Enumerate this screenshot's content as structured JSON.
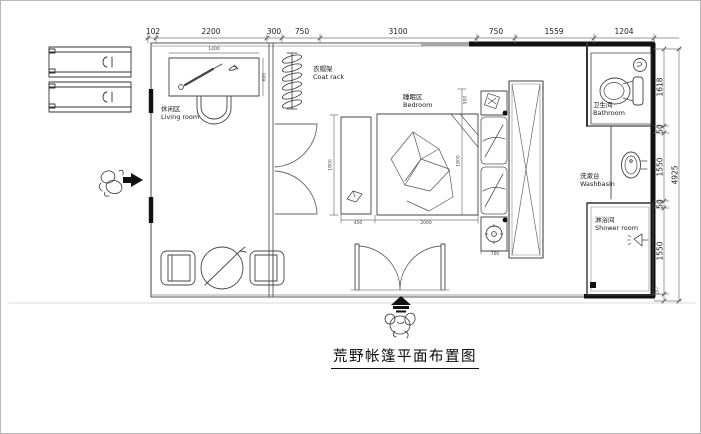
{
  "title": "荒野帐篷平面布置图",
  "rooms": {
    "living": {
      "zh": "休闲区",
      "en": "Living room"
    },
    "coat_rack": {
      "zh": "衣帽架",
      "en": "Coat rack"
    },
    "bedroom": {
      "zh": "睡眠区",
      "en": "Bedroom"
    },
    "bathroom": {
      "zh": "卫生间",
      "en": "Bathroom"
    },
    "washbasin": {
      "zh": "洗漱台",
      "en": "Washbasin"
    },
    "shower": {
      "zh": "淋浴间",
      "en": "Shower room"
    }
  },
  "dims": {
    "top": [
      "102",
      "2200",
      "300",
      "750",
      "3100",
      "750",
      "1559",
      "1204"
    ],
    "right": [
      "1618",
      "50",
      "1550",
      "50",
      "1550",
      "107"
    ],
    "right_overall": "4925",
    "small": {
      "desk_width": "1400",
      "desk_depth": "600",
      "bench_width": "450",
      "bed_width": "2000",
      "bed_length": "1800",
      "bed_length_mid": "1800",
      "nightstand_width": "700",
      "nightstand_depth": "500"
    }
  },
  "colors": {
    "wall": "#111111",
    "line": "#444444",
    "dim": "#555555",
    "background": "#ffffff"
  }
}
